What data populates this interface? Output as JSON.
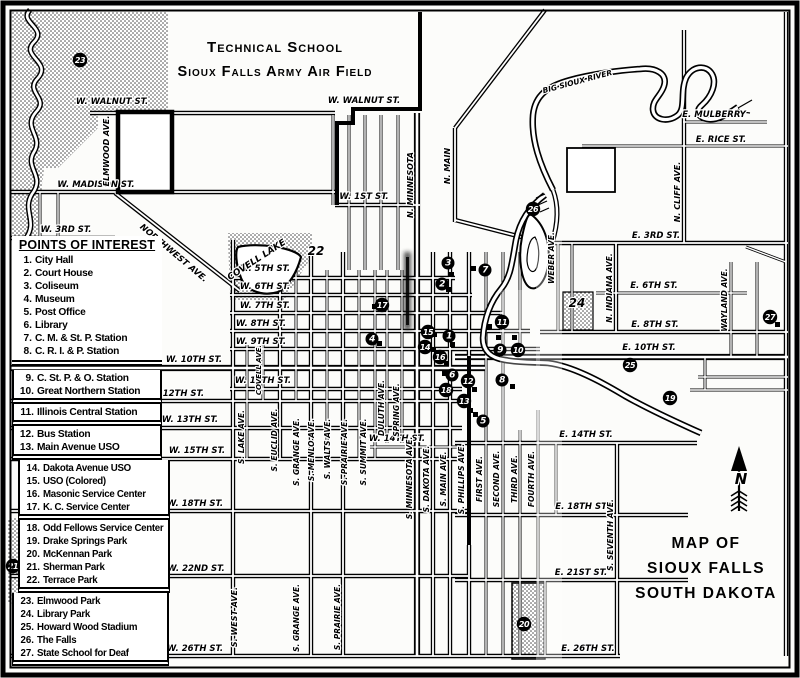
{
  "map": {
    "title_top": [
      "Technical School",
      "Sioux Falls Army Air Field"
    ],
    "title_bottom": [
      "MAP OF",
      "SIOUX FALLS",
      "SOUTH DAKOTA"
    ],
    "compass": "N"
  },
  "legend": {
    "header": "POINTS OF INTEREST",
    "groups": [
      [
        {
          "n": "1.",
          "label": "City Hall"
        },
        {
          "n": "2.",
          "label": "Court House"
        },
        {
          "n": "3.",
          "label": "Coliseum"
        },
        {
          "n": "4.",
          "label": "Museum"
        },
        {
          "n": "5.",
          "label": "Post Office"
        },
        {
          "n": "6.",
          "label": "Library"
        },
        {
          "n": "7.",
          "label": "C. M. & St. P. Station"
        },
        {
          "n": "8.",
          "label": "C. R. I. & P. Station"
        }
      ],
      [
        {
          "n": "9.",
          "label": "C. St. P. & O. Station"
        },
        {
          "n": "10.",
          "label": "Great Northern Station"
        }
      ],
      [
        {
          "n": "11.",
          "label": "Illinois Central Station"
        }
      ],
      [
        {
          "n": "12.",
          "label": "Bus Station"
        },
        {
          "n": "13.",
          "label": "Main Avenue USO"
        }
      ],
      [
        {
          "n": "14.",
          "label": "Dakota Avenue USO"
        },
        {
          "n": "15.",
          "label": "USO (Colored)"
        },
        {
          "n": "16.",
          "label": "Masonic Service Center"
        },
        {
          "n": "17.",
          "label": "K. C. Service Center"
        }
      ],
      [
        {
          "n": "18.",
          "label": "Odd Fellows Service Center"
        },
        {
          "n": "19.",
          "label": "Drake Springs Park"
        },
        {
          "n": "20.",
          "label": "McKennan Park"
        },
        {
          "n": "21.",
          "label": "Sherman Park"
        },
        {
          "n": "22.",
          "label": "Terrace Park"
        }
      ],
      [
        {
          "n": "23.",
          "label": "Elmwood Park"
        },
        {
          "n": "24.",
          "label": "Library Park"
        },
        {
          "n": "25.",
          "label": "Howard Wood Stadium"
        },
        {
          "n": "26.",
          "label": "The Falls"
        },
        {
          "n": "27.",
          "label": "State School for Deaf"
        }
      ]
    ]
  },
  "street_labels": [
    {
      "t": "W. WALNUT ST.",
      "x": 112,
      "y": 104
    },
    {
      "t": "W. WALNUT ST.",
      "x": 364,
      "y": 103
    },
    {
      "t": "W. MADISON ST.",
      "x": 96,
      "y": 187
    },
    {
      "t": "W. 3RD ST.",
      "x": 66,
      "y": 232
    },
    {
      "t": "W. 1ST ST.",
      "x": 364,
      "y": 199
    },
    {
      "t": "W. 5TH ST.",
      "x": 265,
      "y": 271
    },
    {
      "t": "W. 6TH ST.",
      "x": 265,
      "y": 289
    },
    {
      "t": "W. 7TH ST.",
      "x": 265,
      "y": 308
    },
    {
      "t": "W. 8TH ST.",
      "x": 261,
      "y": 326
    },
    {
      "t": "W. 9TH ST.",
      "x": 261,
      "y": 344
    },
    {
      "t": "W. 10TH ST.",
      "x": 194,
      "y": 362
    },
    {
      "t": "W. 11TH ST.",
      "x": 263,
      "y": 383
    },
    {
      "t": "W. 12TH ST.",
      "x": 176,
      "y": 396
    },
    {
      "t": "W. 13TH ST.",
      "x": 190,
      "y": 422
    },
    {
      "t": "W. 14TH ST.",
      "x": 397,
      "y": 441
    },
    {
      "t": "W. 15TH ST.",
      "x": 197,
      "y": 453
    },
    {
      "t": "W. 18TH ST.",
      "x": 195,
      "y": 506
    },
    {
      "t": "W. 22ND ST.",
      "x": 196,
      "y": 571
    },
    {
      "t": "W. 26TH ST.",
      "x": 195,
      "y": 651
    },
    {
      "t": "E. 3RD ST.",
      "x": 656,
      "y": 238
    },
    {
      "t": "E. 6TH ST.",
      "x": 654,
      "y": 288
    },
    {
      "t": "E. 8TH ST.",
      "x": 655,
      "y": 327
    },
    {
      "t": "E. 10TH ST.",
      "x": 649,
      "y": 350
    },
    {
      "t": "E. 14TH ST.",
      "x": 586,
      "y": 437
    },
    {
      "t": "E. 18TH ST.",
      "x": 582,
      "y": 509
    },
    {
      "t": "E. 21ST ST.",
      "x": 581,
      "y": 575
    },
    {
      "t": "E. 26TH ST.",
      "x": 588,
      "y": 651
    },
    {
      "t": "E. MULBERRY",
      "x": 714,
      "y": 117
    },
    {
      "t": "E. RICE ST.",
      "x": 721,
      "y": 142
    },
    {
      "t": "BIG SIOUX RIVER",
      "x": 578,
      "y": 84,
      "r": -15,
      "fs": 7.5
    },
    {
      "t": "NORTHWEST AVE.",
      "x": 172,
      "y": 255,
      "r": 40
    },
    {
      "t": "COVELL LAKE",
      "x": 258,
      "y": 262,
      "r": -33,
      "fs": 9
    },
    {
      "t": "ELMWOOD AVE.",
      "x": 109,
      "y": 151,
      "r": -90,
      "fs": 8
    },
    {
      "t": "N. MINNESOTA",
      "x": 413,
      "y": 185,
      "r": -90,
      "fs": 8
    },
    {
      "t": "N. MAIN",
      "x": 450,
      "y": 166,
      "r": -90,
      "fs": 8
    },
    {
      "t": "WEBER AVE.",
      "x": 554,
      "y": 258,
      "r": -90,
      "fs": 7.5
    },
    {
      "t": "N. INDIANA AVE.",
      "x": 612,
      "y": 288,
      "r": -90,
      "fs": 7.5
    },
    {
      "t": "N. CLIFF AVE.",
      "x": 680,
      "y": 192,
      "r": -90,
      "fs": 8
    },
    {
      "t": "WAYLAND AVE.",
      "x": 727,
      "y": 300,
      "r": -90,
      "fs": 7.5
    },
    {
      "t": "S. WEST AVE.",
      "x": 237,
      "y": 617,
      "r": -90,
      "fs": 8
    },
    {
      "t": "S. LAKE AVE.",
      "x": 244,
      "y": 437,
      "r": -90,
      "fs": 7.5
    },
    {
      "t": "S. EUCLID AVE.",
      "x": 277,
      "y": 440,
      "r": -90,
      "fs": 7.5
    },
    {
      "t": "S. GRANGE AVE.",
      "x": 299,
      "y": 452,
      "r": -90,
      "fs": 7.5
    },
    {
      "t": "S. MENLO AVE.",
      "x": 314,
      "y": 450,
      "r": -90,
      "fs": 7.5
    },
    {
      "t": "S. WALTS AVE.",
      "x": 330,
      "y": 449,
      "r": -90,
      "fs": 7.5
    },
    {
      "t": "S. PRAIRIE AVE.",
      "x": 347,
      "y": 452,
      "r": -90,
      "fs": 7.5
    },
    {
      "t": "S. SUMMIT AVE.",
      "x": 366,
      "y": 452,
      "r": -90,
      "fs": 7.5
    },
    {
      "t": "DULUTH AVE.",
      "x": 384,
      "y": 408,
      "r": -90,
      "fs": 7.5
    },
    {
      "t": "SPRING AVE.",
      "x": 399,
      "y": 410,
      "r": -90,
      "fs": 7.5
    },
    {
      "t": "S. MINNESOTA AVE.",
      "x": 412,
      "y": 478,
      "r": -90,
      "fs": 7.5
    },
    {
      "t": "S. DAKOTA AVE.",
      "x": 429,
      "y": 479,
      "r": -90,
      "fs": 7.5
    },
    {
      "t": "S. MAIN AVE.",
      "x": 446,
      "y": 479,
      "r": -90,
      "fs": 7.5
    },
    {
      "t": "S. PHILLIPS AVE.",
      "x": 464,
      "y": 479,
      "r": -90,
      "fs": 7.5
    },
    {
      "t": "FIRST AVE.",
      "x": 482,
      "y": 479,
      "r": -90,
      "fs": 7.5
    },
    {
      "t": "SECOND AVE.",
      "x": 499,
      "y": 479,
      "r": -90,
      "fs": 7.5
    },
    {
      "t": "THIRD AVE.",
      "x": 517,
      "y": 479,
      "r": -90,
      "fs": 7.5
    },
    {
      "t": "FOURTH AVE.",
      "x": 534,
      "y": 479,
      "r": -90,
      "fs": 7.5
    },
    {
      "t": "S. SEVENTH AVE.",
      "x": 613,
      "y": 535,
      "r": -90,
      "fs": 7.5
    },
    {
      "t": "S. GRANGE AVE.",
      "x": 299,
      "y": 618,
      "r": -90,
      "fs": 7.5
    },
    {
      "t": "S. PRAIRIE AVE.",
      "x": 340,
      "y": 617,
      "r": -90,
      "fs": 7.5
    },
    {
      "t": "COVELL AVE.",
      "x": 261,
      "y": 370,
      "r": -90,
      "fs": 7
    }
  ],
  "markers": [
    {
      "n": "1",
      "x": 449,
      "y": 336
    },
    {
      "n": "2",
      "x": 442,
      "y": 284
    },
    {
      "n": "3",
      "x": 448,
      "y": 263
    },
    {
      "n": "4",
      "x": 372,
      "y": 339
    },
    {
      "n": "5",
      "x": 483,
      "y": 421
    },
    {
      "n": "6",
      "x": 452,
      "y": 375
    },
    {
      "n": "7",
      "x": 485,
      "y": 270
    },
    {
      "n": "8",
      "x": 502,
      "y": 380
    },
    {
      "n": "9",
      "x": 500,
      "y": 350
    },
    {
      "n": "10",
      "x": 518,
      "y": 350
    },
    {
      "n": "11",
      "x": 502,
      "y": 322
    },
    {
      "n": "12",
      "x": 468,
      "y": 381
    },
    {
      "n": "13",
      "x": 464,
      "y": 401
    },
    {
      "n": "14",
      "x": 425,
      "y": 347
    },
    {
      "n": "15",
      "x": 428,
      "y": 332
    },
    {
      "n": "16",
      "x": 440,
      "y": 357
    },
    {
      "n": "17",
      "x": 382,
      "y": 305
    },
    {
      "n": "18",
      "x": 446,
      "y": 390
    },
    {
      "n": "19",
      "x": 670,
      "y": 398
    },
    {
      "n": "20",
      "x": 524,
      "y": 624
    },
    {
      "n": "21",
      "x": 13,
      "y": 566
    },
    {
      "n": "23",
      "x": 80,
      "y": 60
    },
    {
      "n": "25",
      "x": 630,
      "y": 365
    },
    {
      "n": "26",
      "x": 533,
      "y": 209
    },
    {
      "n": "27",
      "x": 770,
      "y": 317
    }
  ],
  "park_numbers": [
    {
      "n": "22",
      "x": 316,
      "y": 251
    },
    {
      "n": "24",
      "x": 577,
      "y": 303
    }
  ],
  "buildings": [
    [
      471,
      266
    ],
    [
      449,
      272
    ],
    [
      446,
      287
    ],
    [
      487,
      324
    ],
    [
      496,
      335
    ],
    [
      512,
      335
    ],
    [
      450,
      342
    ],
    [
      444,
      361
    ],
    [
      442,
      371
    ],
    [
      472,
      387
    ],
    [
      510,
      384
    ],
    [
      468,
      408
    ],
    [
      473,
      412
    ],
    [
      372,
      304
    ],
    [
      377,
      341
    ],
    [
      432,
      332
    ],
    [
      431,
      347
    ],
    [
      775,
      322
    ]
  ]
}
